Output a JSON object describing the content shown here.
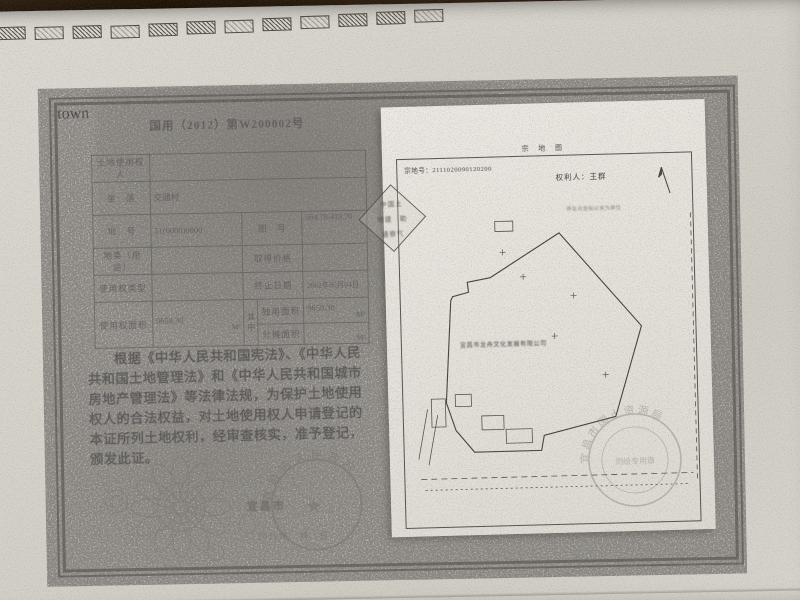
{
  "palette": {
    "desk_wood": "#2a1d11",
    "paper": "#d6d3cb",
    "map_sheet": "#e7e4dd",
    "ink": "#37363c",
    "border_ink": "#53504a",
    "stamp_gray": "#8a7e70"
  },
  "certificate": {
    "serial": "国用（2012）第W200002号",
    "fold_mark": "◁",
    "table": {
      "row1": {
        "label": "土地使用权人",
        "value": ""
      },
      "row2": {
        "label": "坐　落",
        "value": "交通村"
      },
      "row3": {
        "label": "地　号",
        "value": "51(0000)0000",
        "label2": "图　号",
        "value2": "564.78-419.70"
      },
      "row4": {
        "label": "地类（用途）",
        "value": "",
        "label2": "取得价格",
        "value2": ""
      },
      "row5": {
        "label": "使用权类型",
        "value": "",
        "label2": "终止日期",
        "value2": "2062年05月04日"
      },
      "row6": {
        "label": "使用权面积",
        "value": "9658.30",
        "unit": "M²",
        "mid": "其中",
        "sub1_label": "独用面积",
        "sub1_value": "9658.30",
        "sub1_unit": "M²",
        "sub2_label": "分摊面积",
        "sub2_value": "",
        "sub2_unit": "M²"
      }
    },
    "body_text": "根据《中华人民共和国宪法》、《中华人民共和国土地管理法》和《中华人民共和国城市房地产管理法》等法律法规，为保护土地使用权人的合法权益，对土地使用权人申请登记的本证所列土地权利，经审查核实，准予登记，颁发此证。",
    "issuer": "宜昌市",
    "issue_date": "2012年　月　日",
    "seal": {
      "arc_text": "宜昌市人民政府",
      "star": "★"
    }
  },
  "parcel_map": {
    "title": "宗 地 图",
    "parcel_no": "宗地号：2111020090120200",
    "holder": "权利人：王群",
    "note": "界址点坐标以米为单位",
    "company_label": "宜昌市龙舟文化发展有限公司",
    "diamond_stamp": {
      "line1": "中国土",
      "line2": "地建　助",
      "line3": "通察气"
    },
    "round_stamp": {
      "arc_text": "宜昌市国土资源局",
      "inner_text": "测绘专用章"
    }
  }
}
